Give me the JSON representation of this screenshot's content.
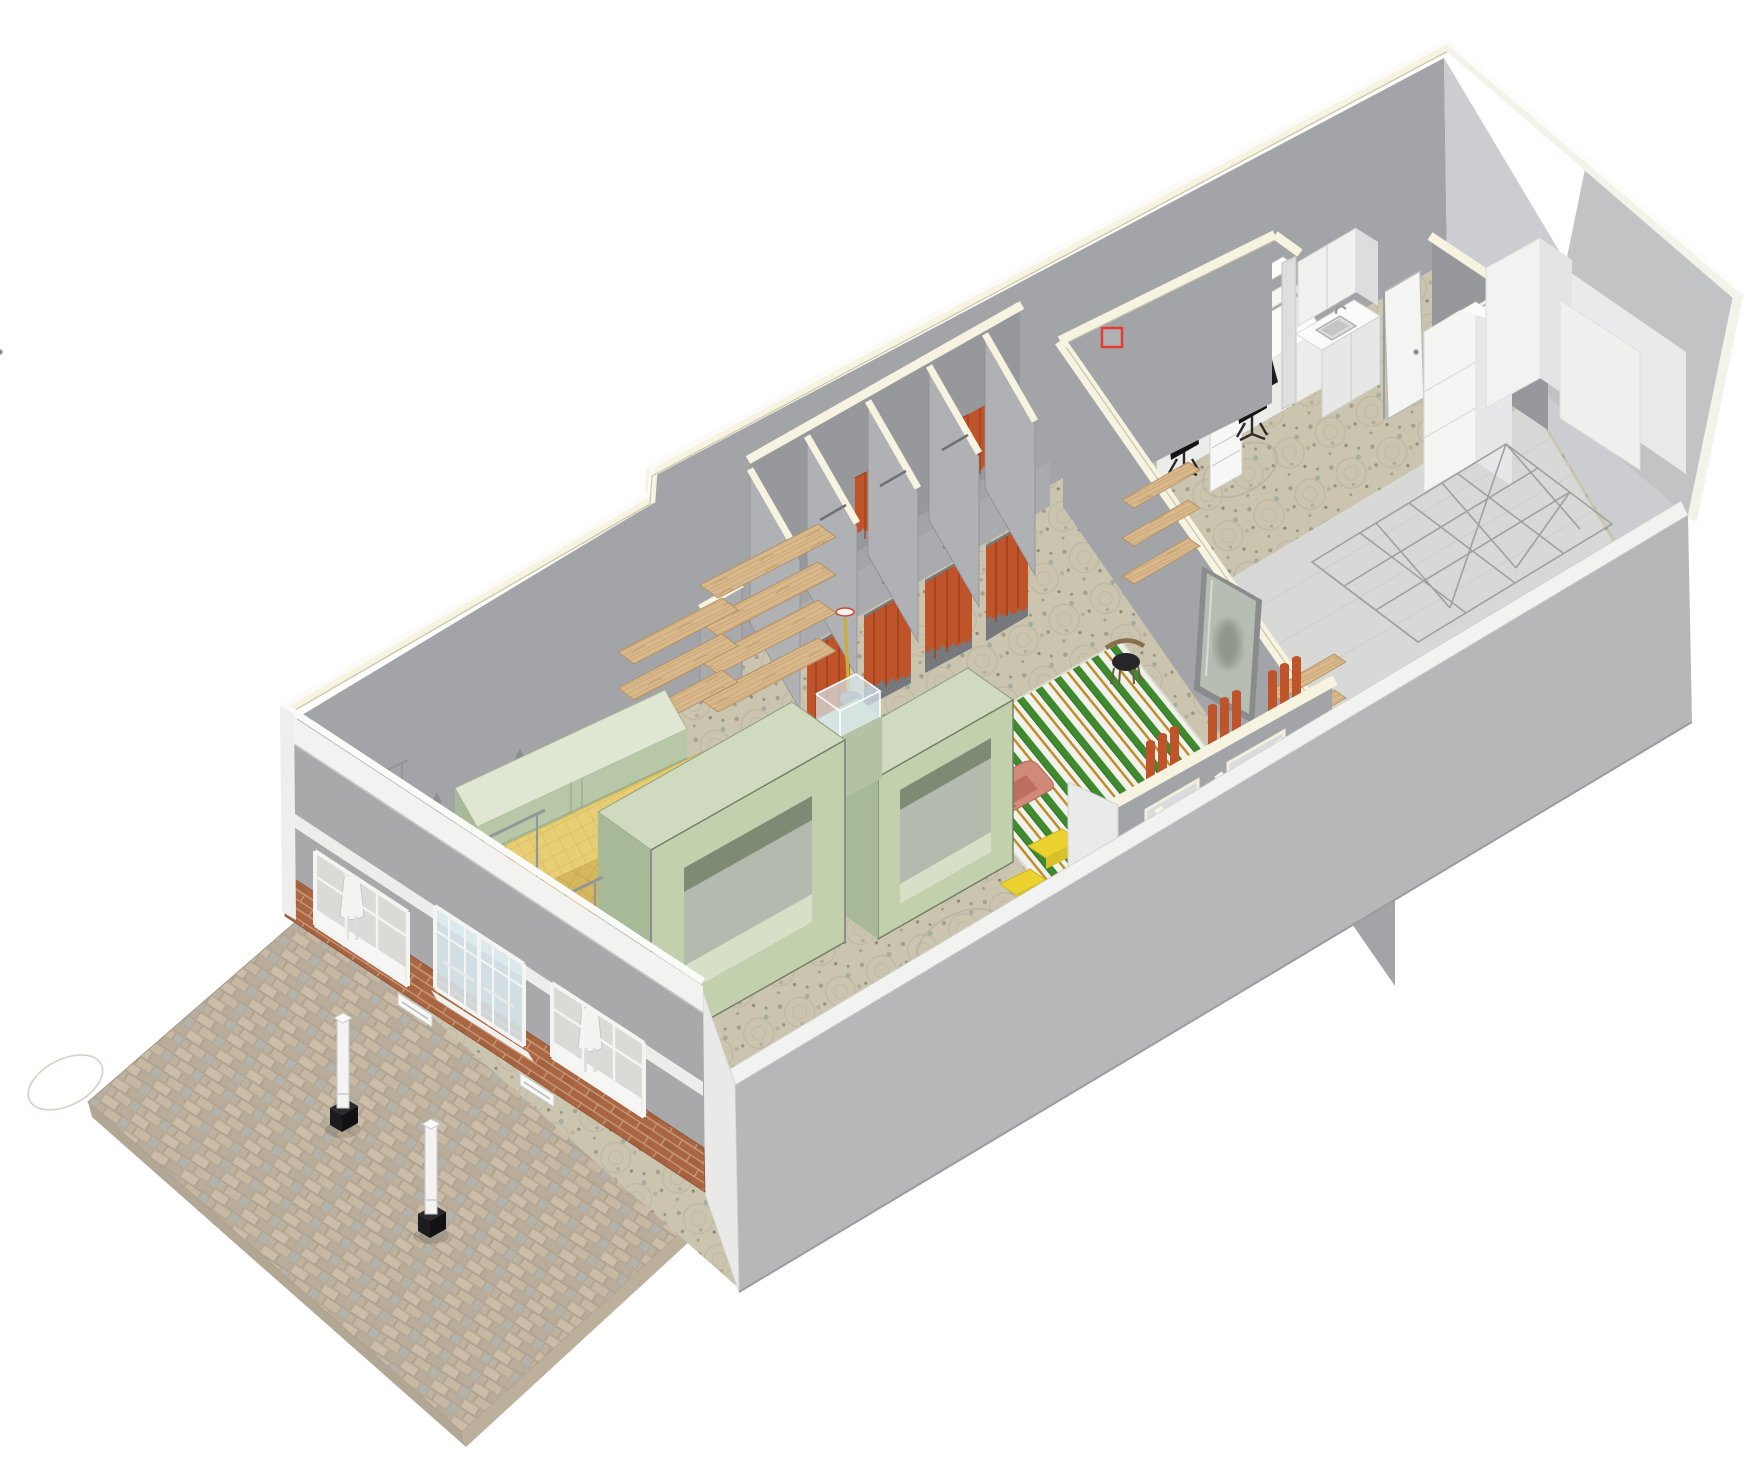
{
  "view": {
    "title": "3D axonometric cutaway view - retail store fit-out",
    "background": "#ffffff"
  },
  "selection_marquee": {
    "x": 1102,
    "y": 328,
    "width": 20,
    "height": 19,
    "color": "#e8392e"
  },
  "palette": {
    "cut_cream": "#f6f3e1",
    "cut_cream_edge": "#c9c5ad",
    "wall_gray": "#a3a4a7",
    "wall_gray_dark": "#97989b",
    "wall_gray_mid": "#b0b1b4",
    "wall_gray_light": "#cccdd0",
    "exterior_gray": "#b6b7b9",
    "bump_gray": "#c2c3c5",
    "white_surface": "#f4f4f3",
    "white_shade": "#e6e7e8",
    "facade_gray": "#a9a9ab",
    "cornice_white": "#f2f2f0",
    "brick": "#aa6643",
    "brick_mortar": "#c79b7c",
    "pavement": "#c3b6a3",
    "pavement_alt": "#b2a794",
    "terrazzo": "#cbc5b0",
    "terrazzo_speck": "#a89d87",
    "concrete": "#d8d8d6",
    "wood": "#d9b98c",
    "wood_edge": "#b08e62",
    "mint_top": "#cfdabf",
    "mint_front": "#c2d0ae",
    "mint_side": "#a7b996",
    "mint_cabinet_top": "#dfe7d2",
    "mint_cabinet_front": "#b7c7a7",
    "yellow_counter": "#e7cd74",
    "yellow_counter_side": "#d5b75e",
    "curtain_orange": "#bf5329",
    "curtain_fold": "#9a3d1a",
    "rug_green": "#3f8a2f",
    "rug_white": "#f2f2ec",
    "rug_gold": "#c08a28",
    "chair_pink": "#d18a7a",
    "chair_pink_dark": "#bc6f5f",
    "table_yellow": "#ecd22e",
    "seat_black": "#1e1e20",
    "glass": "#d8e9ef",
    "mirror": "#b6bdb2",
    "steel": "#95969a"
  },
  "scene": {
    "exterior": [
      {
        "id": "sidewalk",
        "label": "brick-paved sidewalk"
      },
      {
        "id": "bollard-1",
        "label": "security bollard"
      },
      {
        "id": "bollard-2",
        "label": "security bollard"
      },
      {
        "id": "storefront-facade",
        "label": "storefront facade with brick base"
      },
      {
        "id": "display-window-1",
        "label": "display window with mannequin"
      },
      {
        "id": "entry-door",
        "label": "glazed entry double door"
      },
      {
        "id": "display-window-2",
        "label": "display window with mannequin"
      }
    ],
    "sales_floor": [
      {
        "id": "terrazzo-floor",
        "label": "patterned terrazzo sales floor"
      },
      {
        "id": "wall-rails",
        "label": "wall-mounted display rails with busts"
      },
      {
        "id": "wood-shelves-left",
        "label": "floating wood shelves"
      },
      {
        "id": "mint-credenza",
        "label": "mint display credenza"
      },
      {
        "id": "yellow-display-counter",
        "label": "yellow gridded display counter"
      },
      {
        "id": "display-tunnel-1",
        "label": "mint display tunnel unit"
      },
      {
        "id": "display-tunnel-2",
        "label": "mint display tunnel unit"
      },
      {
        "id": "vitrine-pedestal",
        "label": "glass vitrine on mint pedestal"
      },
      {
        "id": "acrylic-risers",
        "label": "white acrylic risers"
      },
      {
        "id": "clothing-racks",
        "label": "freestanding clothing rails"
      },
      {
        "id": "floor-lamp",
        "label": "floor lamp with yellow stem"
      }
    ],
    "fitting_area": [
      {
        "id": "fitting-rooms-left",
        "label": "fitting rooms with orange curtains"
      },
      {
        "id": "fitting-rooms-right",
        "label": "fitting rooms along front wall (section cut)"
      },
      {
        "id": "lounge-rug",
        "label": "green striped lounge rug"
      },
      {
        "id": "pink-lounge-chair-1",
        "label": "pink sculptural lounge chair"
      },
      {
        "id": "pink-lounge-chair-2",
        "label": "pink sculptural lounge chair"
      },
      {
        "id": "yellow-side-tables",
        "label": "yellow side tables"
      },
      {
        "id": "black-chair",
        "label": "black cafe chair"
      },
      {
        "id": "wall-shelves-right",
        "label": "wood shelves on partition"
      },
      {
        "id": "leaning-mirror",
        "label": "large leaning mirror"
      }
    ],
    "back_of_house": [
      {
        "id": "office-desk",
        "label": "office desk with task chairs"
      },
      {
        "id": "kitchenette",
        "label": "kitchenette with sink"
      },
      {
        "id": "office-door",
        "label": "office door"
      },
      {
        "id": "wc-room",
        "label": "accessible WC with grab bars"
      },
      {
        "id": "storage-cabinets",
        "label": "white storage cabinets"
      },
      {
        "id": "pallet-racking",
        "label": "wireframe pallet racking layout"
      }
    ]
  }
}
